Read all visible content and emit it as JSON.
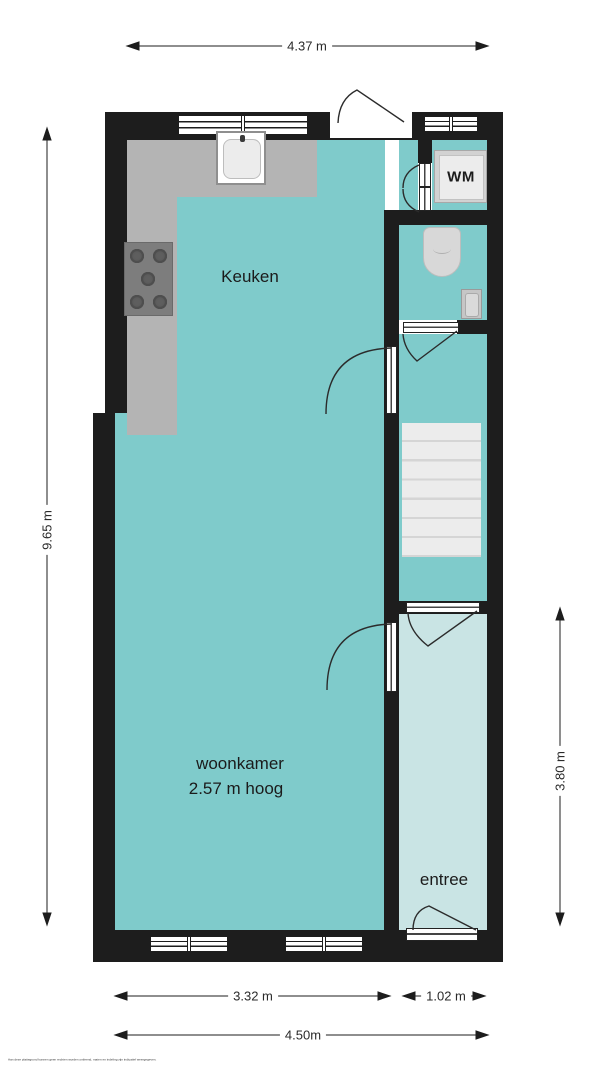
{
  "rooms": {
    "keuken": {
      "label": "Keuken"
    },
    "woonkamer": {
      "label": "woonkamer",
      "height_note": "2.57 m hoog"
    },
    "entree": {
      "label": "entree"
    },
    "wasmachine": {
      "label": "WM"
    }
  },
  "dimensions": {
    "width_top": "4.37 m",
    "height_left": "9.65 m",
    "height_entree_right": "3.80 m",
    "width_bottom_living": "3.32 m",
    "width_bottom_entree": "1.02 m",
    "width_bottom_total": "4.50m"
  },
  "colors": {
    "wall": "#1d1d1d",
    "room_fill": "#7fcbcb",
    "entree_fill": "#c9e4e4",
    "kitchen_counter": "#b4b4b4",
    "stove": "#7d7d7d",
    "fixtures": "#d9d9d9",
    "stairs": "#ececec"
  },
  "disclaimer": "Aan deze plattegrond kunnen geen rechten worden ontleend, maten en indeling zijn indicatief weergegeven."
}
